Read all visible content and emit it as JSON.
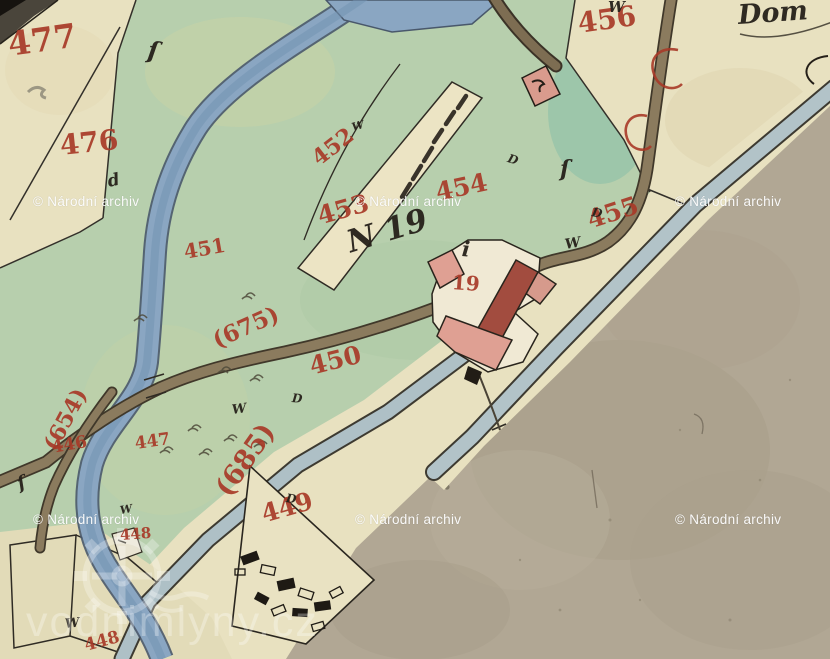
{
  "map": {
    "colors": {
      "red_ink": "#a83a28",
      "black_ink": "#26211a",
      "paper_cream": "#e8e1c0",
      "paper_tan": "#b1a794",
      "meadow_green": "#b7cfad",
      "river_blue": "#8aa6c2",
      "road_gray_blue": "#b2c3c8",
      "road_brown": "#8b7b5e",
      "building_pink": "#dfa093",
      "building_dark_red": "#a24c3f",
      "watermark_white": "rgba(255,255,255,0.95)",
      "site_watermark_white": "rgba(255,255,255,0.30)"
    },
    "labels": [
      {
        "kind": "red",
        "text": "477",
        "x": 8,
        "y": 28,
        "size": 33,
        "rot": -8
      },
      {
        "kind": "red",
        "text": "476",
        "x": 60,
        "y": 132,
        "size": 28,
        "rot": -6
      },
      {
        "kind": "red",
        "text": "456",
        "x": 578,
        "y": 10,
        "size": 28,
        "rot": -8
      },
      {
        "kind": "red",
        "text": "452",
        "x": 315,
        "y": 150,
        "size": 22,
        "rot": -38
      },
      {
        "kind": "red",
        "text": "453",
        "x": 318,
        "y": 204,
        "size": 25,
        "rot": -16
      },
      {
        "kind": "red",
        "text": "454",
        "x": 436,
        "y": 180,
        "size": 25,
        "rot": -12
      },
      {
        "kind": "red",
        "text": "455",
        "x": 588,
        "y": 208,
        "size": 25,
        "rot": -18
      },
      {
        "kind": "red",
        "text": "451",
        "x": 184,
        "y": 242,
        "size": 20,
        "rot": -10
      },
      {
        "kind": "red",
        "text": "450",
        "x": 310,
        "y": 354,
        "size": 25,
        "rot": -14
      },
      {
        "kind": "red",
        "text": "(675)",
        "x": 214,
        "y": 330,
        "size": 23,
        "rot": -24
      },
      {
        "kind": "red",
        "text": "(685)",
        "x": 222,
        "y": 480,
        "size": 27,
        "rot": -55
      },
      {
        "kind": "red",
        "text": "(654)",
        "x": 50,
        "y": 438,
        "size": 22,
        "rot": -62
      },
      {
        "kind": "red",
        "text": "446",
        "x": 52,
        "y": 440,
        "size": 17,
        "rot": -10
      },
      {
        "kind": "red",
        "text": "447",
        "x": 135,
        "y": 436,
        "size": 17,
        "rot": -8
      },
      {
        "kind": "red",
        "text": "448",
        "x": 120,
        "y": 528,
        "size": 15,
        "rot": -4
      },
      {
        "kind": "red",
        "text": "449",
        "x": 262,
        "y": 502,
        "size": 25,
        "rot": -16
      },
      {
        "kind": "red",
        "text": "448",
        "x": 85,
        "y": 638,
        "size": 17,
        "rot": -15
      },
      {
        "kind": "red",
        "text": "19",
        "x": 452,
        "y": 272,
        "size": 20,
        "rot": 4
      },
      {
        "kind": "ink",
        "text": "Dom",
        "x": 738,
        "y": 2,
        "size": 27,
        "rot": -4
      },
      {
        "kind": "ink",
        "text": "N 19",
        "x": 348,
        "y": 228,
        "size": 31,
        "rot": -17
      },
      {
        "kind": "ink",
        "text": "W",
        "x": 608,
        "y": 0,
        "size": 15,
        "rot": 0
      },
      {
        "kind": "ink",
        "text": "W",
        "x": 565,
        "y": 238,
        "size": 14,
        "rot": -10
      },
      {
        "kind": "ink",
        "text": "W",
        "x": 352,
        "y": 122,
        "size": 11,
        "rot": -15
      },
      {
        "kind": "ink",
        "text": "W",
        "x": 232,
        "y": 404,
        "size": 13,
        "rot": -8
      },
      {
        "kind": "ink",
        "text": "W",
        "x": 65,
        "y": 618,
        "size": 13,
        "rot": -6
      },
      {
        "kind": "ink",
        "text": "W",
        "x": 120,
        "y": 505,
        "size": 11,
        "rot": -10
      },
      {
        "kind": "ink",
        "text": "D",
        "x": 508,
        "y": 152,
        "size": 12,
        "rot": 18
      },
      {
        "kind": "ink",
        "text": "D",
        "x": 592,
        "y": 206,
        "size": 12,
        "rot": 10
      },
      {
        "kind": "ink",
        "text": "D",
        "x": 286,
        "y": 492,
        "size": 12,
        "rot": 8
      },
      {
        "kind": "ink",
        "text": "D",
        "x": 292,
        "y": 392,
        "size": 12,
        "rot": 5
      },
      {
        "kind": "ink",
        "text": "i",
        "x": 462,
        "y": 238,
        "size": 21,
        "rot": 5
      },
      {
        "kind": "ink",
        "text": "d",
        "x": 108,
        "y": 174,
        "size": 17,
        "rot": -12
      },
      {
        "kind": "ink",
        "text": "ſ",
        "x": 148,
        "y": 38,
        "size": 24,
        "rot": 8
      },
      {
        "kind": "ink",
        "text": "ſ",
        "x": 560,
        "y": 158,
        "size": 22,
        "rot": 0
      },
      {
        "kind": "ink",
        "text": "ſ",
        "x": 18,
        "y": 476,
        "size": 18,
        "rot": -20
      }
    ],
    "watermarks": {
      "archive": {
        "text": "© Národní archiv",
        "positions": [
          {
            "x": 33,
            "y": 195
          },
          {
            "x": 355,
            "y": 195
          },
          {
            "x": 675,
            "y": 195
          },
          {
            "x": 33,
            "y": 513
          },
          {
            "x": 355,
            "y": 513
          },
          {
            "x": 675,
            "y": 513
          }
        ]
      },
      "site": {
        "text": "vodnimlyny.cz"
      }
    }
  }
}
